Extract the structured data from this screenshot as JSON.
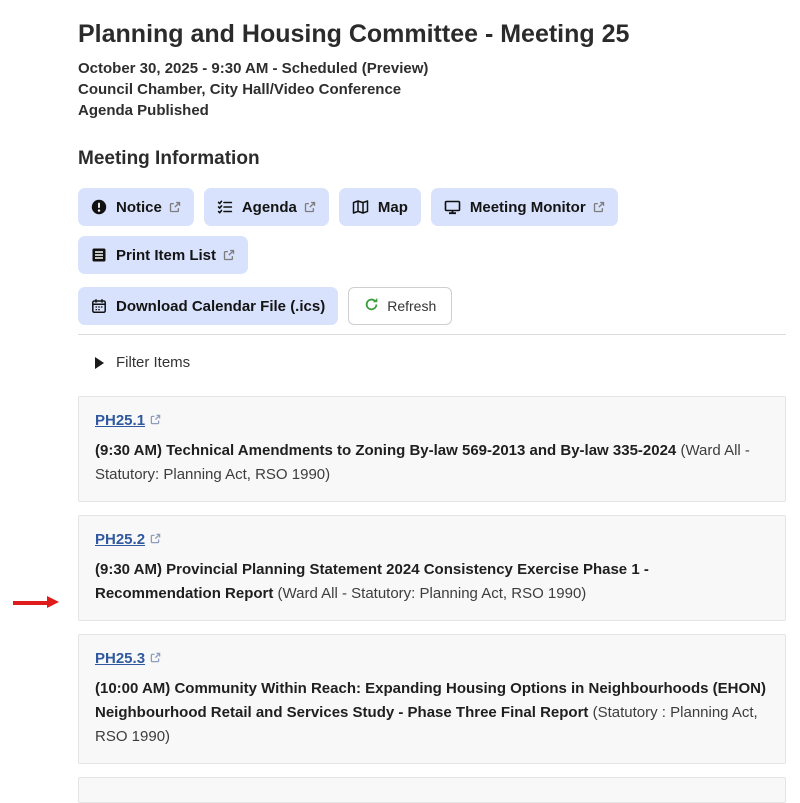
{
  "page": {
    "title": "Planning and Housing Committee - Meeting 25",
    "subtitle_lines": [
      "October 30, 2025 - 9:30 AM - Scheduled (Preview)",
      "Council Chamber, City Hall/Video Conference",
      "Agenda Published"
    ],
    "section_heading": "Meeting Information"
  },
  "toolbar": {
    "buttons_row1": [
      {
        "label": "Notice",
        "icon": "exclamation-circle-icon",
        "external_link": true
      },
      {
        "label": "Agenda",
        "icon": "checklist-icon",
        "external_link": true
      },
      {
        "label": "Map",
        "icon": "map-icon",
        "external_link": false
      },
      {
        "label": "Meeting Monitor",
        "icon": "monitor-icon",
        "external_link": true
      },
      {
        "label": "Print Item List",
        "icon": "list-document-icon",
        "external_link": true
      }
    ],
    "buttons_row2": [
      {
        "label": "Download Calendar File (.ics)",
        "icon": "calendar-icon",
        "external_link": false
      }
    ],
    "refresh_label": "Refresh"
  },
  "filter": {
    "label": "Filter Items",
    "state": "collapsed"
  },
  "items": [
    {
      "id": "PH25.1",
      "title": "(9:30 AM) Technical Amendments to Zoning By-law 569-2013 and By-law 335-2024",
      "meta": "(Ward All - Statutory: Planning Act, RSO 1990)"
    },
    {
      "id": "PH25.2",
      "title": "(9:30 AM) Provincial Planning Statement 2024 Consistency Exercise Phase 1 - Recommendation Report",
      "meta": "(Ward All - Statutory: Planning Act, RSO 1990)"
    },
    {
      "id": "PH25.3",
      "title": "(10:00 AM) Community Within Reach: Expanding Housing Options in Neighbourhoods (EHON) Neighbourhood Retail and Services Study - Phase Three Final Report",
      "meta": "(Statutory : Planning Act, RSO 1990)",
      "annotated": true
    }
  ],
  "annotation": {
    "type": "red-arrow",
    "points_to": "PH25.3",
    "color": "#e01b1b"
  },
  "colors": {
    "button_bg": "#d9e2fc",
    "link_blue": "#31599f",
    "refresh_green": "#3a9e3a",
    "card_bg": "#f8f8f8",
    "card_border": "#e4e4e4",
    "arrow_red": "#e01b1b"
  }
}
